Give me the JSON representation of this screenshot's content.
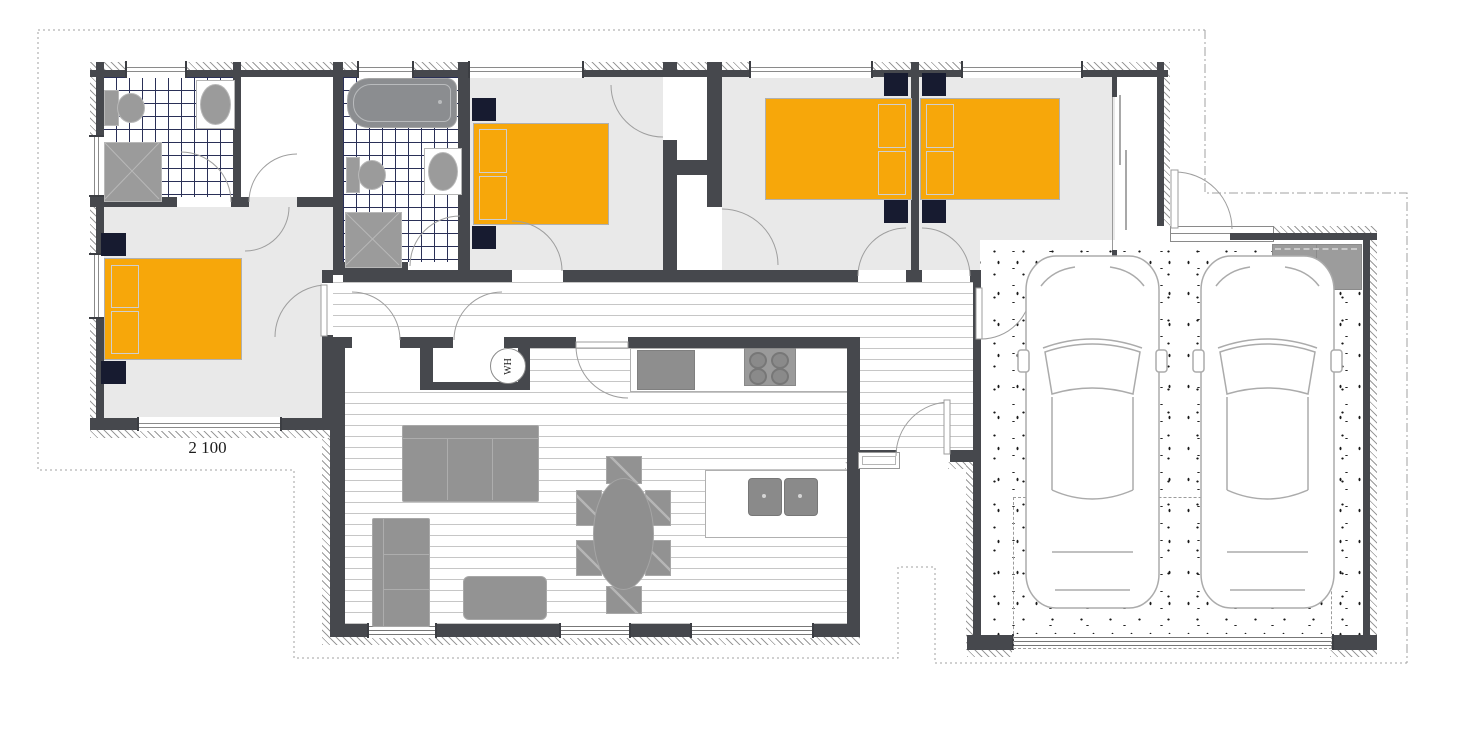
{
  "plan": {
    "dimension_label": "2 100",
    "water_heater_label": "WH"
  },
  "colors": {
    "bed_accent": "#F7A70A",
    "nightstand_navy": "#171B30",
    "wall_dark": "#46484D",
    "tile_grid_line": "#2A3057",
    "room_floor_gray": "#E9E9E9",
    "furniture_gray": "#939393",
    "drawing_outline_gray": "#ABABAB",
    "boundary_dotted_gray": "#A0A0A0"
  }
}
